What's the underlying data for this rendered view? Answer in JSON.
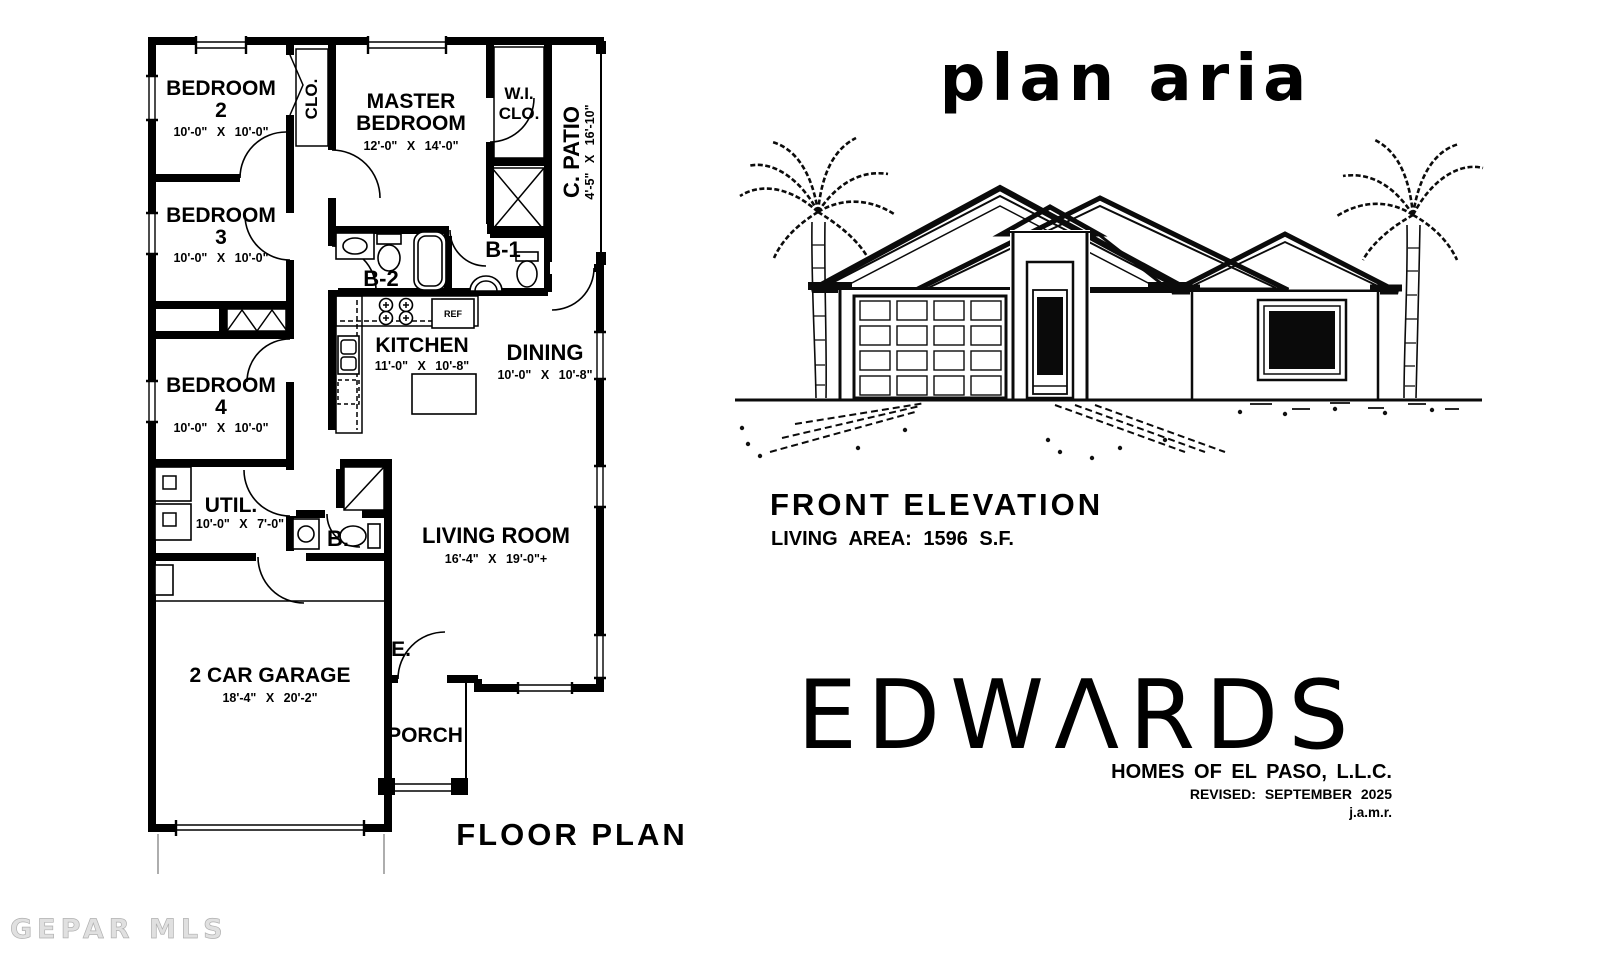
{
  "page": {
    "title_handwritten": "plan aria",
    "floor_plan_caption": "FLOOR PLAN",
    "watermark": "GEPAR MLS"
  },
  "elevation": {
    "caption": "FRONT ELEVATION",
    "living_area": "LIVING AREA: 1596 S.F."
  },
  "brand": {
    "name": "EDWARDS",
    "display": "EDWΛRDS",
    "tagline": "HOMES OF EL PASO, L.L.C.",
    "revised": "REVISED: SEPTEMBER 2025",
    "drafter": "j.a.m.r."
  },
  "rooms": {
    "bedroom2": {
      "line1": "BEDROOM",
      "line2": "2",
      "dims": "10'-0\" X 10'-0\""
    },
    "bedroom3": {
      "line1": "BEDROOM",
      "line2": "3",
      "dims": "10'-0\" X 10'-0\""
    },
    "bedroom4": {
      "line1": "BEDROOM",
      "line2": "4",
      "dims": "10'-0\" X 10'-0\""
    },
    "master": {
      "line1": "MASTER",
      "line2": "BEDROOM",
      "dims": "12'-0\" X 14'-0\""
    },
    "wic": {
      "line1": "W.I.",
      "line2": "CLO."
    },
    "closet": {
      "label": "CLO."
    },
    "patio": {
      "label": "C. PATIO",
      "dims": "4'-5\" X 16'-10\""
    },
    "bath1": {
      "label": "B-1"
    },
    "bath2": {
      "label": "B-2"
    },
    "kitchen": {
      "label": "KITCHEN",
      "dims": "11'-0\" X 10'-8\""
    },
    "dining": {
      "label": "DINING",
      "dims": "10'-0\" X 10'-8\""
    },
    "living": {
      "label": "LIVING ROOM",
      "dims": "16'-4\" X 19'-0\"+"
    },
    "util": {
      "label": "UTIL.",
      "dims": "10'-0\" X 7'-0\""
    },
    "bath_half": {
      "label": "B."
    },
    "entry": {
      "label": "E."
    },
    "porch": {
      "label": "PORCH"
    },
    "garage": {
      "label": "2 CAR GARAGE",
      "dims": "18'-4\" X 20'-2\""
    },
    "appliance_ref": {
      "label": "REF"
    }
  }
}
